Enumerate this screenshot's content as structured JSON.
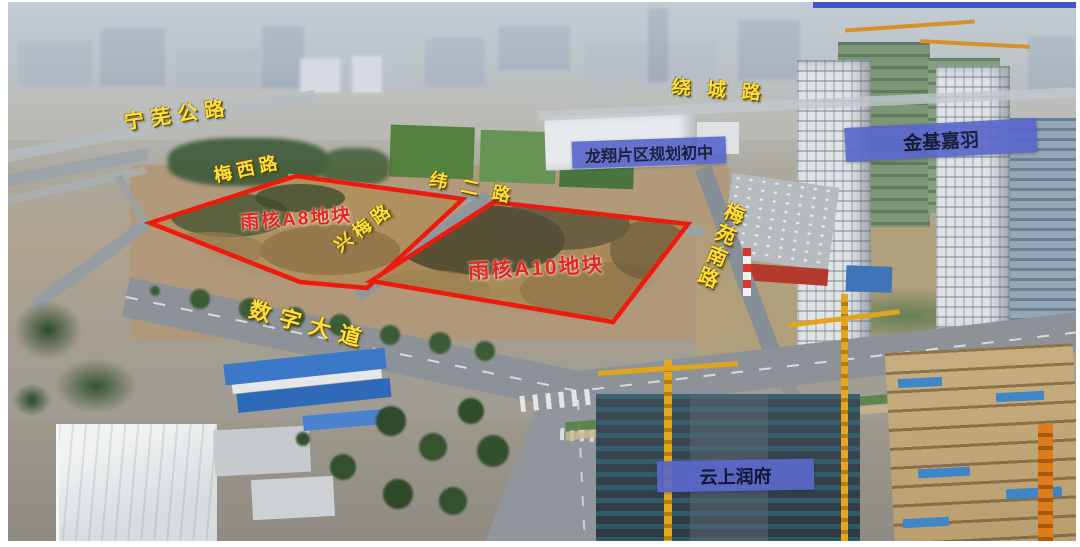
{
  "labels": {
    "roads": [
      {
        "id": "ningwu",
        "text": "宁芜公路"
      },
      {
        "id": "raocheng",
        "text": "绕城路"
      },
      {
        "id": "meixi",
        "text": "梅西路"
      },
      {
        "id": "weier",
        "text": "纬二路"
      },
      {
        "id": "xingmei",
        "text": "兴梅路"
      },
      {
        "id": "meiyuan",
        "text": "梅苑南路"
      },
      {
        "id": "shuzi",
        "text": "数字大道"
      }
    ],
    "parcels": [
      {
        "id": "a8",
        "text": "雨核A8地块"
      },
      {
        "id": "a10",
        "text": "雨核A10地块"
      }
    ],
    "places": [
      {
        "id": "longxiang",
        "text": "龙翔片区规划初中"
      },
      {
        "id": "jinji",
        "text": "金基嘉羽"
      },
      {
        "id": "yunshang",
        "text": "云上润府"
      }
    ]
  },
  "colors": {
    "road_label": "#ffdf3a",
    "parcel_label": "#e6261a",
    "parcel_outline": "#ef1a0e",
    "place_box_bg": "#5a68cb",
    "place_box_text": "#0d1130"
  }
}
